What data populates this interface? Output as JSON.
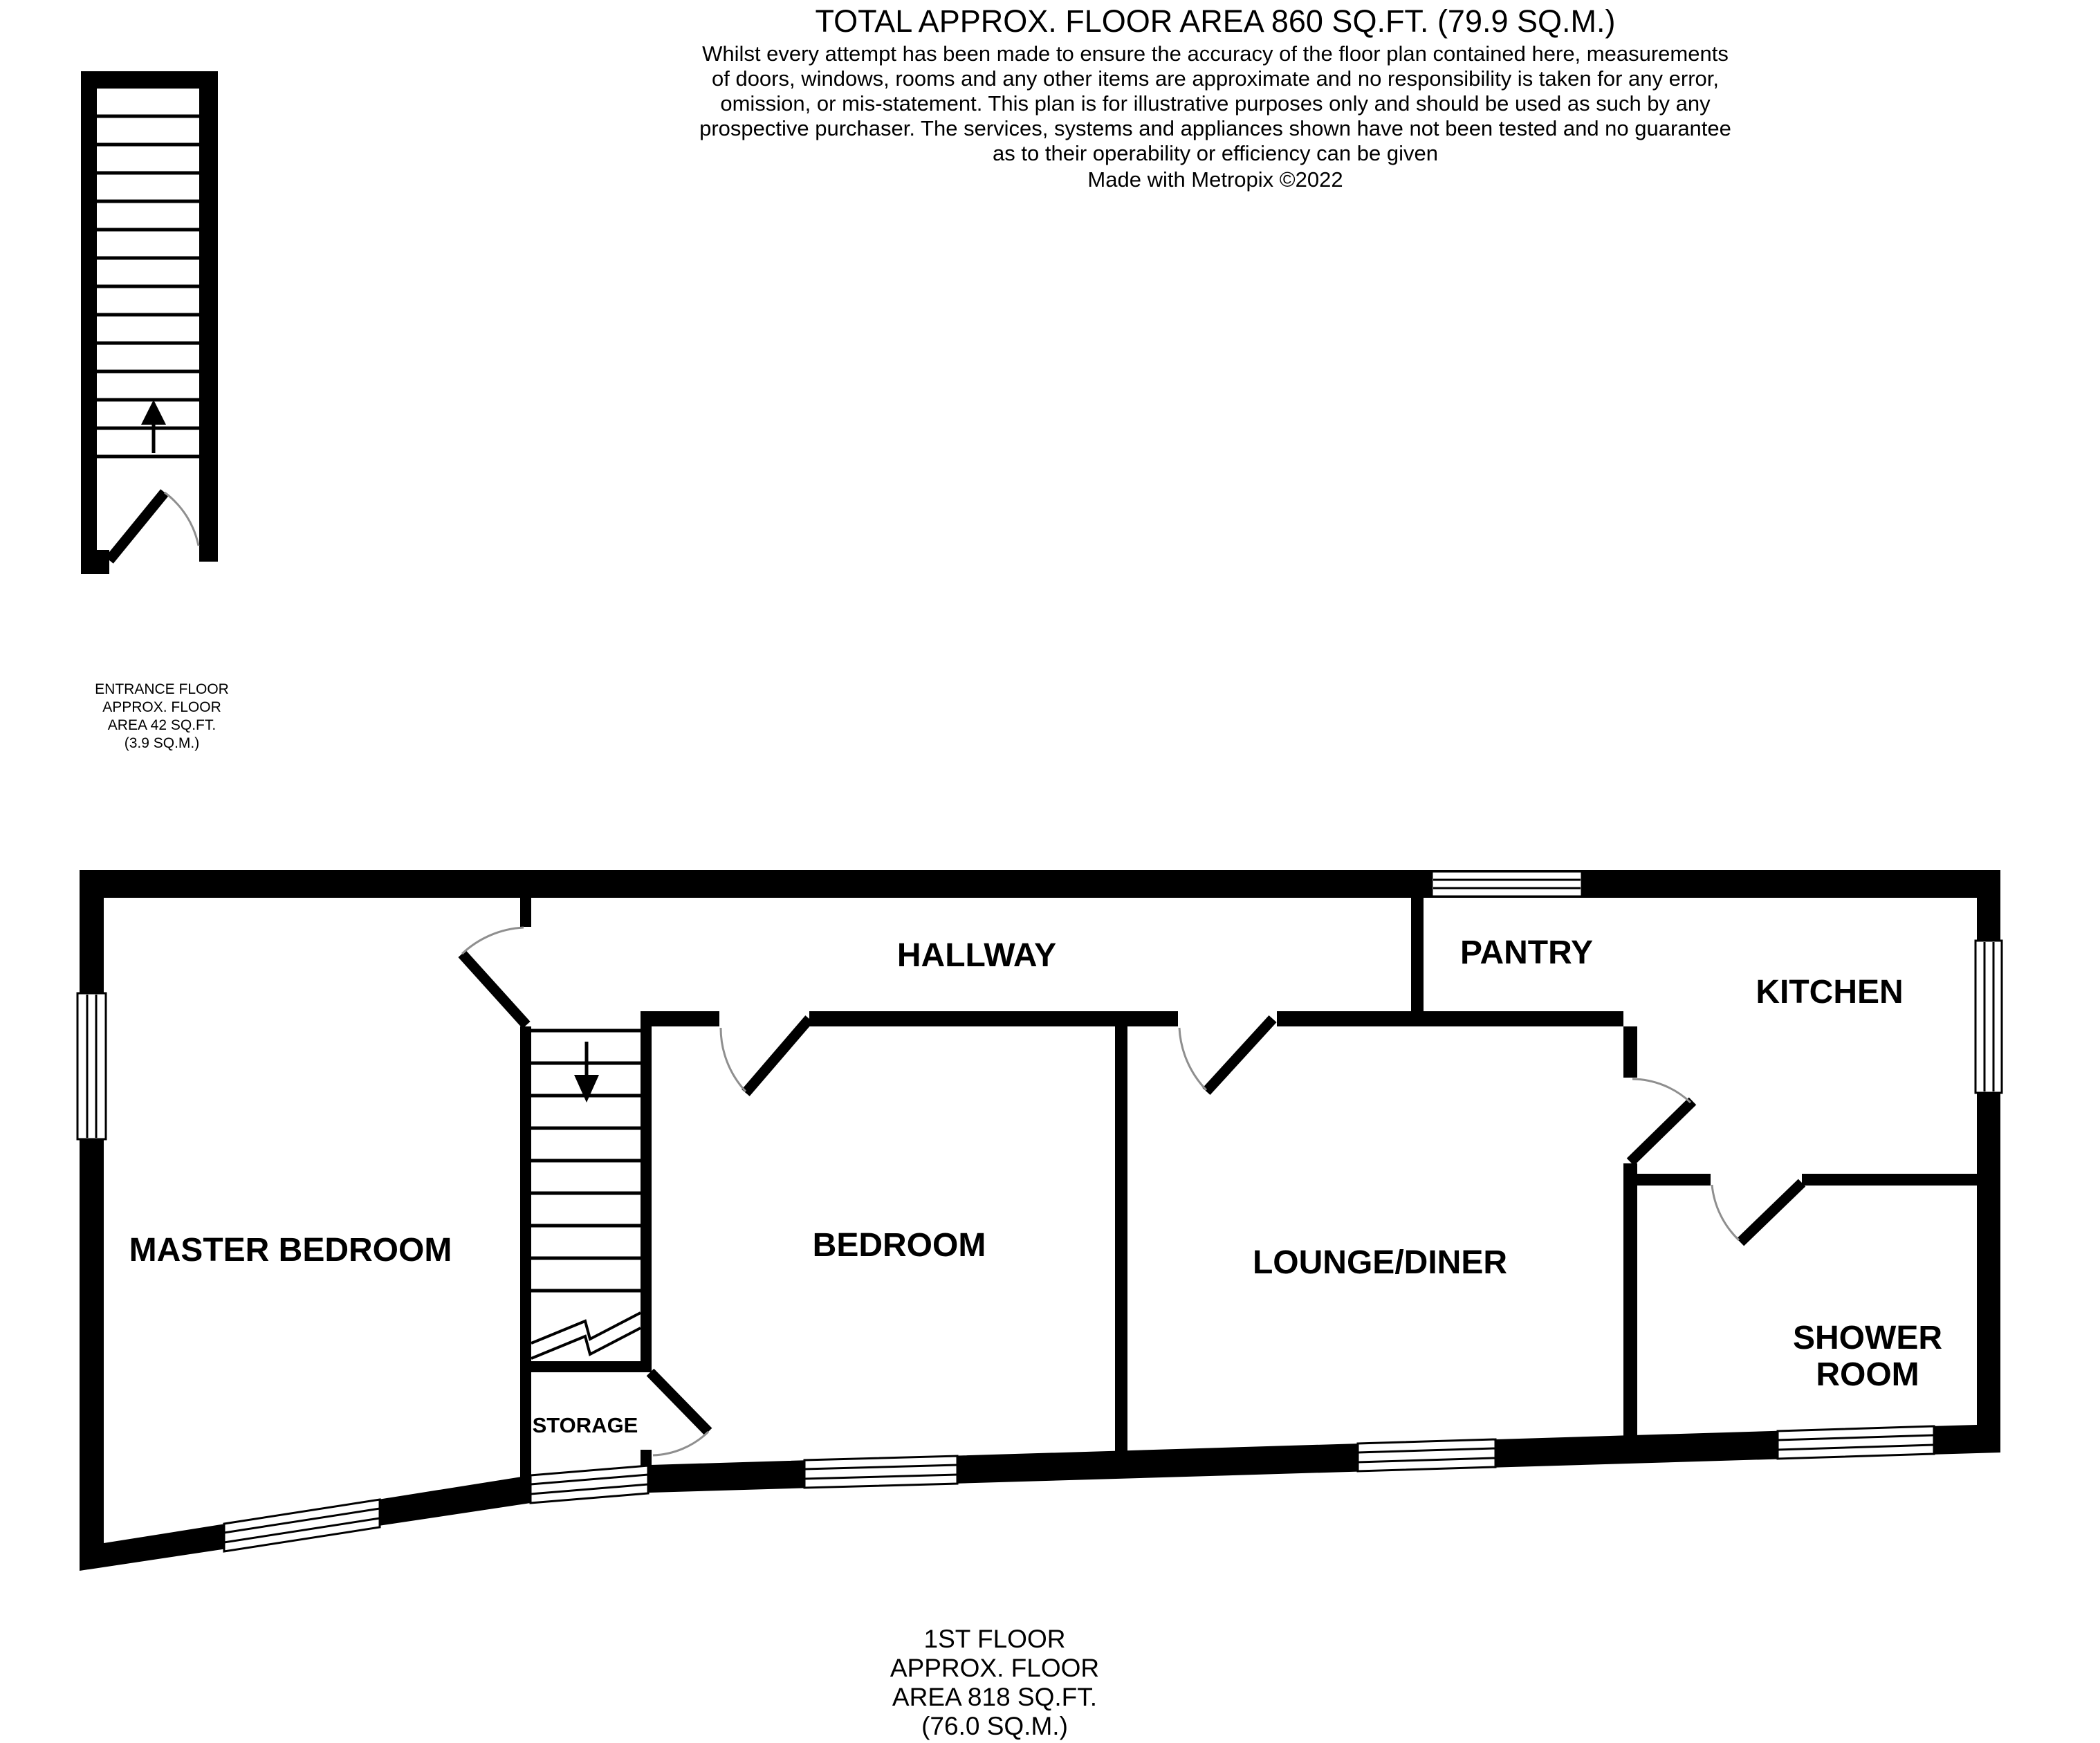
{
  "header": {
    "title": "TOTAL APPROX. FLOOR AREA 860 SQ.FT. (79.9 SQ.M.)",
    "disclaimer_lines": [
      "Whilst every attempt has been made to ensure the accuracy of the floor plan contained here, measurements",
      "of doors, windows, rooms and any other items are approximate and no responsibility is taken for any error,",
      "omission, or mis-statement. This plan is for illustrative purposes only and should be used as such by any",
      "prospective purchaser. The services, systems and appliances shown have not been tested and no guarantee",
      "as to their operability or efficiency can be given"
    ],
    "credit": "Made with Metropix ©2022"
  },
  "entrance_floor": {
    "label_lines": [
      "ENTRANCE FLOOR",
      "APPROX. FLOOR",
      "AREA 42 SQ.FT.",
      "(3.9 SQ.M.)"
    ]
  },
  "first_floor": {
    "rooms": {
      "hallway": "HALLWAY",
      "master_bedroom": "MASTER BEDROOM",
      "bedroom": "BEDROOM",
      "lounge_diner": "LOUNGE/DINER",
      "pantry": "PANTRY",
      "kitchen": "KITCHEN",
      "shower_room_line1": "SHOWER",
      "shower_room_line2": "ROOM",
      "storage": "STORAGE"
    },
    "label_lines": [
      "1ST FLOOR",
      "APPROX. FLOOR",
      "AREA 818 SQ.FT.",
      "(76.0 SQ.M.)"
    ]
  },
  "colors": {
    "wall": "#000000",
    "text": "#000000",
    "door_arc": "#8f8f8f",
    "background": "#ffffff"
  }
}
